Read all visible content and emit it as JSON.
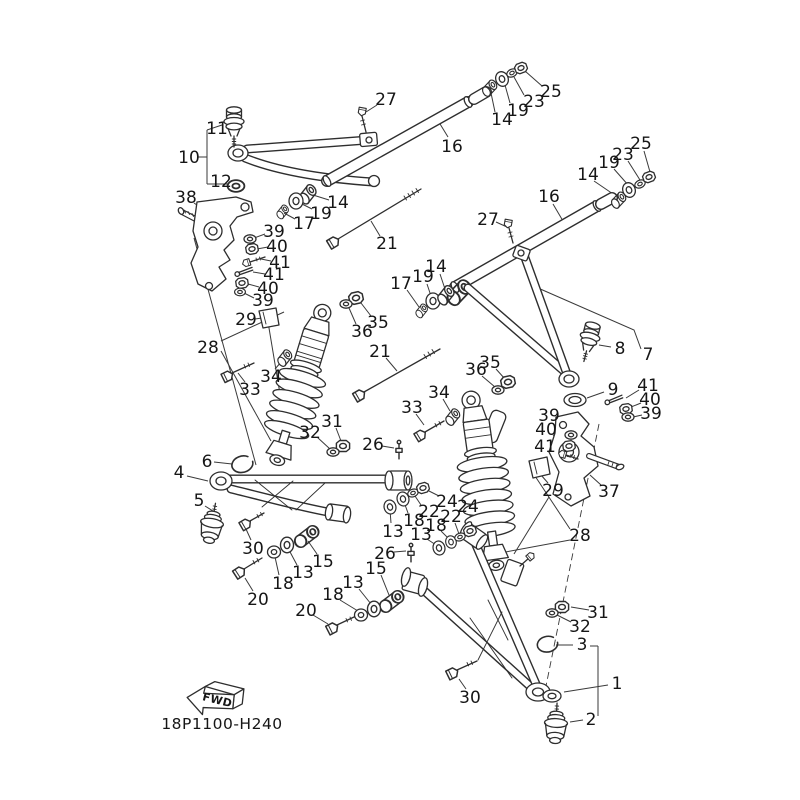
{
  "diagram": {
    "code": "18P1100-H240",
    "fwd_label": "FWD",
    "colors": {
      "line": "#2e2e2e",
      "text": "#161616",
      "background": "#ffffff"
    },
    "callouts": [
      {
        "t": "11",
        "x": 217,
        "y": 128,
        "pts": [
          [
            227,
            126
          ],
          [
            236,
            118
          ]
        ]
      },
      {
        "t": "10",
        "x": 189,
        "y": 157,
        "pts": [
          [
            198,
            157
          ],
          [
            207,
            157
          ]
        ]
      },
      {
        "t": "12",
        "x": 221,
        "y": 181,
        "pts": [
          [
            229,
            183
          ],
          [
            234,
            186
          ]
        ]
      },
      {
        "t": "38",
        "x": 186,
        "y": 197,
        "pts": [
          [
            194,
            203
          ],
          [
            207,
            212
          ]
        ]
      },
      {
        "t": "27",
        "x": 386,
        "y": 99,
        "pts": [
          [
            377,
            105
          ],
          [
            366,
            112
          ]
        ]
      },
      {
        "t": "16",
        "x": 452,
        "y": 146,
        "pts": [
          [
            448,
            137
          ],
          [
            437,
            119
          ]
        ]
      },
      {
        "t": "25",
        "x": 551,
        "y": 91,
        "pts": [
          [
            542,
            86
          ],
          [
            525,
            71
          ]
        ]
      },
      {
        "t": "23",
        "x": 534,
        "y": 101,
        "pts": [
          [
            524,
            95
          ],
          [
            514,
            77
          ]
        ]
      },
      {
        "t": "19",
        "x": 518,
        "y": 110,
        "pts": [
          [
            510,
            103
          ],
          [
            505,
            85
          ]
        ]
      },
      {
        "t": "14",
        "x": 502,
        "y": 119,
        "pts": [
          [
            495,
            112
          ],
          [
            491,
            93
          ]
        ]
      },
      {
        "t": "25",
        "x": 641,
        "y": 143,
        "pts": [
          [
            644,
            151
          ],
          [
            650,
            172
          ]
        ]
      },
      {
        "t": "23",
        "x": 623,
        "y": 154,
        "pts": [
          [
            628,
            161
          ],
          [
            640,
            180
          ]
        ]
      },
      {
        "t": "19",
        "x": 609,
        "y": 162,
        "pts": [
          [
            614,
            169
          ],
          [
            629,
            186
          ]
        ]
      },
      {
        "t": "14",
        "x": 588,
        "y": 174,
        "pts": [
          [
            594,
            181
          ],
          [
            616,
            196
          ]
        ]
      },
      {
        "t": "16",
        "x": 549,
        "y": 196,
        "pts": [
          [
            553,
            204
          ],
          [
            563,
            221
          ]
        ]
      },
      {
        "t": "27",
        "x": 488,
        "y": 219,
        "pts": [
          [
            496,
            222
          ],
          [
            507,
            227
          ]
        ]
      },
      {
        "t": "14",
        "x": 338,
        "y": 202,
        "pts": [
          [
            329,
            200
          ],
          [
            313,
            195
          ]
        ]
      },
      {
        "t": "19",
        "x": 321,
        "y": 213,
        "pts": [
          [
            312,
            209
          ],
          [
            300,
            203
          ]
        ]
      },
      {
        "t": "17",
        "x": 304,
        "y": 223,
        "pts": [
          [
            295,
            219
          ],
          [
            284,
            213
          ]
        ]
      },
      {
        "t": "21",
        "x": 387,
        "y": 243,
        "pts": [
          [
            380,
            236
          ],
          [
            371,
            221
          ]
        ]
      },
      {
        "t": "39",
        "x": 274,
        "y": 231,
        "pts": [
          [
            265,
            234
          ],
          [
            254,
            238
          ]
        ]
      },
      {
        "t": "40",
        "x": 277,
        "y": 246,
        "pts": [
          [
            268,
            247
          ],
          [
            257,
            249
          ]
        ]
      },
      {
        "t": "41",
        "x": 280,
        "y": 262,
        "pts": [
          [
            271,
            261
          ],
          [
            261,
            259
          ]
        ]
      },
      {
        "t": "41",
        "x": 274,
        "y": 274,
        "pts": [
          [
            265,
            274
          ],
          [
            253,
            272
          ]
        ]
      },
      {
        "t": "40",
        "x": 268,
        "y": 288,
        "pts": [
          [
            259,
            287
          ],
          [
            248,
            284
          ]
        ]
      },
      {
        "t": "39",
        "x": 263,
        "y": 300,
        "pts": [
          [
            254,
            298
          ],
          [
            244,
            293
          ]
        ]
      },
      {
        "t": "14",
        "x": 436,
        "y": 266,
        "pts": [
          [
            440,
            274
          ],
          [
            446,
            292
          ]
        ]
      },
      {
        "t": "19",
        "x": 423,
        "y": 276,
        "pts": [
          [
            427,
            284
          ],
          [
            432,
            299
          ]
        ]
      },
      {
        "t": "17",
        "x": 401,
        "y": 283,
        "pts": [
          [
            407,
            290
          ],
          [
            419,
            307
          ]
        ]
      },
      {
        "t": "29",
        "x": 246,
        "y": 319,
        "pts": [
          [
            255,
            319
          ],
          [
            262,
            318
          ]
        ]
      },
      {
        "t": "28",
        "x": 208,
        "y": 347
      },
      {
        "t": "35",
        "x": 378,
        "y": 322,
        "pts": [
          [
            371,
            316
          ],
          [
            361,
            303
          ]
        ]
      },
      {
        "t": "36",
        "x": 362,
        "y": 331,
        "pts": [
          [
            356,
            324
          ],
          [
            349,
            308
          ]
        ]
      },
      {
        "t": "34",
        "x": 271,
        "y": 376,
        "pts": [
          [
            275,
            369
          ],
          [
            282,
            361
          ]
        ]
      },
      {
        "t": "33",
        "x": 250,
        "y": 389,
        "pts": [
          [
            245,
            382
          ],
          [
            238,
            373
          ]
        ]
      },
      {
        "t": "21",
        "x": 380,
        "y": 351,
        "pts": [
          [
            386,
            358
          ],
          [
            397,
            371
          ]
        ]
      },
      {
        "t": "31",
        "x": 332,
        "y": 421,
        "pts": [
          [
            336,
            428
          ],
          [
            341,
            441
          ]
        ]
      },
      {
        "t": "32",
        "x": 310,
        "y": 432,
        "pts": [
          [
            317,
            437
          ],
          [
            330,
            449
          ]
        ]
      },
      {
        "t": "26",
        "x": 373,
        "y": 444,
        "pts": [
          [
            382,
            446
          ],
          [
            394,
            448
          ]
        ]
      },
      {
        "t": "6",
        "x": 207,
        "y": 461,
        "pts": [
          [
            214,
            462
          ],
          [
            232,
            464
          ]
        ]
      },
      {
        "t": "4",
        "x": 179,
        "y": 472,
        "pts": [
          [
            187,
            476
          ],
          [
            208,
            481
          ]
        ]
      },
      {
        "t": "5",
        "x": 199,
        "y": 500,
        "pts": [
          [
            205,
            506
          ],
          [
            213,
            511
          ]
        ]
      },
      {
        "t": "30",
        "x": 253,
        "y": 548,
        "pts": [
          [
            251,
            540
          ],
          [
            246,
            529
          ]
        ]
      },
      {
        "t": "15",
        "x": 323,
        "y": 561,
        "pts": [
          [
            317,
            554
          ],
          [
            308,
            541
          ]
        ]
      },
      {
        "t": "13",
        "x": 303,
        "y": 572,
        "pts": [
          [
            297,
            565
          ],
          [
            289,
            550
          ]
        ]
      },
      {
        "t": "18",
        "x": 283,
        "y": 583,
        "pts": [
          [
            279,
            575
          ],
          [
            275,
            557
          ]
        ]
      },
      {
        "t": "20",
        "x": 258,
        "y": 599,
        "pts": [
          [
            253,
            591
          ],
          [
            245,
            578
          ]
        ]
      },
      {
        "t": "8",
        "x": 620,
        "y": 348,
        "pts": [
          [
            611,
            347
          ],
          [
            599,
            345
          ]
        ]
      },
      {
        "t": "7",
        "x": 648,
        "y": 354,
        "pts": [
          [
            641,
            349
          ],
          [
            634,
            330
          ],
          [
            538,
            288
          ]
        ]
      },
      {
        "t": "9",
        "x": 613,
        "y": 389,
        "pts": [
          [
            604,
            392
          ],
          [
            587,
            398
          ]
        ]
      },
      {
        "t": "41",
        "x": 648,
        "y": 385,
        "pts": [
          [
            639,
            390
          ],
          [
            626,
            398
          ]
        ]
      },
      {
        "t": "40",
        "x": 650,
        "y": 399,
        "pts": [
          [
            641,
            403
          ],
          [
            631,
            407
          ]
        ]
      },
      {
        "t": "39",
        "x": 651,
        "y": 413,
        "pts": [
          [
            642,
            415
          ],
          [
            633,
            417
          ]
        ]
      },
      {
        "t": "35",
        "x": 490,
        "y": 362,
        "pts": [
          [
            496,
            369
          ],
          [
            505,
            379
          ]
        ]
      },
      {
        "t": "36",
        "x": 476,
        "y": 369,
        "pts": [
          [
            482,
            376
          ],
          [
            495,
            387
          ]
        ]
      },
      {
        "t": "34",
        "x": 439,
        "y": 392,
        "pts": [
          [
            443,
            399
          ],
          [
            450,
            411
          ]
        ]
      },
      {
        "t": "33",
        "x": 412,
        "y": 407,
        "pts": [
          [
            416,
            414
          ],
          [
            424,
            425
          ]
        ]
      },
      {
        "t": "39",
        "x": 549,
        "y": 415,
        "pts": [
          [
            556,
            421
          ],
          [
            568,
            432
          ]
        ]
      },
      {
        "t": "40",
        "x": 546,
        "y": 429,
        "pts": [
          [
            553,
            435
          ],
          [
            565,
            443
          ]
        ]
      },
      {
        "t": "41",
        "x": 545,
        "y": 446,
        "pts": [
          [
            552,
            450
          ],
          [
            561,
            454
          ]
        ]
      },
      {
        "t": "37",
        "x": 609,
        "y": 491,
        "pts": [
          [
            601,
            485
          ],
          [
            590,
            475
          ]
        ]
      },
      {
        "t": "29",
        "x": 553,
        "y": 490,
        "pts": [
          [
            548,
            483
          ],
          [
            541,
            475
          ]
        ]
      },
      {
        "t": "28",
        "x": 580,
        "y": 535
      },
      {
        "t": "24",
        "x": 447,
        "y": 501,
        "pts": [
          [
            439,
            496
          ],
          [
            427,
            490
          ]
        ]
      },
      {
        "t": "22",
        "x": 429,
        "y": 511,
        "pts": [
          [
            421,
            505
          ],
          [
            415,
            496
          ]
        ]
      },
      {
        "t": "18",
        "x": 414,
        "y": 520,
        "pts": [
          [
            408,
            513
          ],
          [
            404,
            502
          ]
        ]
      },
      {
        "t": "13",
        "x": 393,
        "y": 531,
        "pts": [
          [
            391,
            523
          ],
          [
            390,
            510
          ]
        ]
      },
      {
        "t": "24",
        "x": 468,
        "y": 506,
        "pts": [
          [
            470,
            514
          ],
          [
            471,
            528
          ]
        ]
      },
      {
        "t": "22",
        "x": 451,
        "y": 516,
        "pts": [
          [
            455,
            523
          ],
          [
            459,
            534
          ]
        ]
      },
      {
        "t": "18",
        "x": 436,
        "y": 525,
        "pts": [
          [
            441,
            531
          ],
          [
            449,
            539
          ]
        ]
      },
      {
        "t": "13",
        "x": 421,
        "y": 534,
        "pts": [
          [
            427,
            539
          ],
          [
            436,
            545
          ]
        ]
      },
      {
        "t": "26",
        "x": 385,
        "y": 553,
        "pts": [
          [
            394,
            552
          ],
          [
            406,
            551
          ]
        ]
      },
      {
        "t": "15",
        "x": 376,
        "y": 568,
        "pts": [
          [
            381,
            575
          ],
          [
            389,
            595
          ]
        ]
      },
      {
        "t": "13",
        "x": 353,
        "y": 582,
        "pts": [
          [
            359,
            589
          ],
          [
            371,
            604
          ]
        ]
      },
      {
        "t": "18",
        "x": 333,
        "y": 594,
        "pts": [
          [
            340,
            600
          ],
          [
            358,
            611
          ]
        ]
      },
      {
        "t": "20",
        "x": 306,
        "y": 610,
        "pts": [
          [
            313,
            615
          ],
          [
            328,
            624
          ]
        ]
      },
      {
        "t": "31",
        "x": 598,
        "y": 612,
        "pts": [
          [
            589,
            610
          ],
          [
            571,
            607
          ]
        ]
      },
      {
        "t": "32",
        "x": 580,
        "y": 626,
        "pts": [
          [
            571,
            622
          ],
          [
            557,
            615
          ]
        ]
      },
      {
        "t": "3",
        "x": 582,
        "y": 644,
        "pts": [
          [
            573,
            645
          ],
          [
            556,
            645
          ]
        ]
      },
      {
        "t": "1",
        "x": 617,
        "y": 683,
        "pts": [
          [
            608,
            685
          ],
          [
            564,
            692
          ]
        ]
      },
      {
        "t": "2",
        "x": 591,
        "y": 719,
        "pts": [
          [
            583,
            720
          ],
          [
            570,
            722
          ]
        ]
      },
      {
        "t": "30",
        "x": 470,
        "y": 697,
        "pts": [
          [
            466,
            689
          ],
          [
            459,
            679
          ]
        ]
      }
    ],
    "extra_lines": [
      [
        221,
        341,
        284,
        312
      ],
      [
        221,
        351,
        271,
        441
      ],
      [
        570,
        529,
        535,
        476
      ],
      [
        570,
        540,
        484,
        556
      ],
      [
        207,
        130,
        207,
        184
      ],
      [
        207,
        130,
        222,
        125
      ],
      [
        207,
        184,
        229,
        184
      ],
      [
        268,
        322,
        284,
        418
      ],
      [
        549,
        497,
        514,
        554
      ],
      [
        590,
        646,
        598,
        646
      ],
      [
        598,
        646,
        598,
        716
      ],
      [
        194,
        238,
        256,
        465
      ]
    ],
    "dash_lines": [
      [
        599,
        424,
        546,
        686
      ]
    ]
  }
}
